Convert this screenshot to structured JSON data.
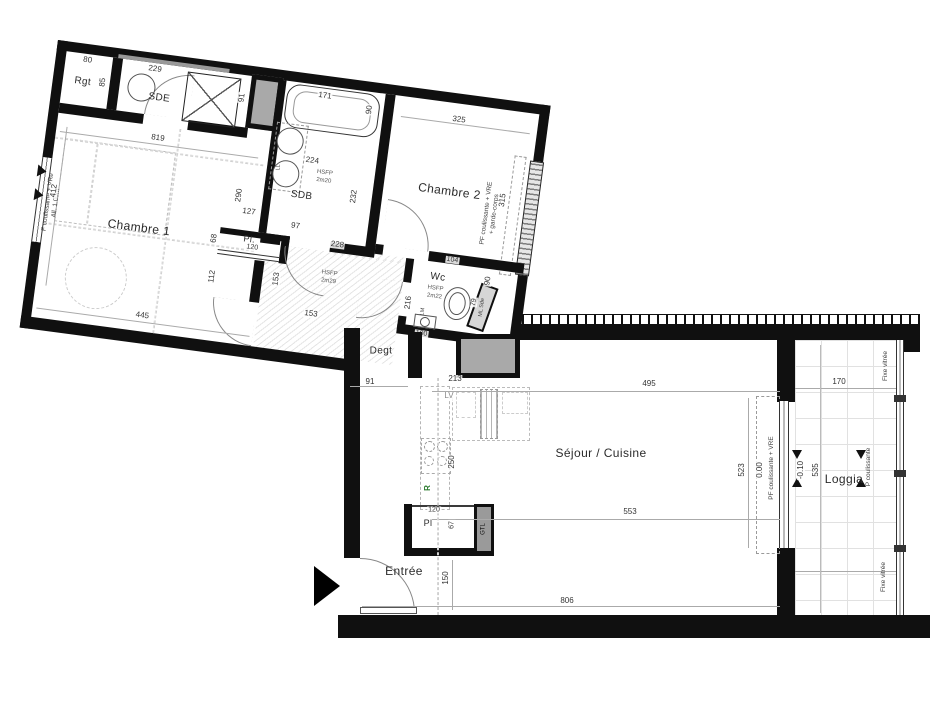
{
  "meta": {
    "wall_color": "#101010",
    "duct_color": "#a9a9a9",
    "accent_green": "#2e7d32"
  },
  "rooms": {
    "rgt": "Rgt",
    "sde": "SDE",
    "sdb": "SDB",
    "chambre1": "Chambre 1",
    "chambre2": "Chambre 2",
    "wc": "Wc",
    "degt": "Degt",
    "sejour": "Séjour / Cuisine",
    "entree": "Entrée",
    "loggia": "Loggia",
    "pl1": "Pl.",
    "pl2": "Pl"
  },
  "fixtures": {
    "lv": "LV",
    "fridge": "R",
    "gtl": "GTL",
    "ll": "LL",
    "lm": "LM",
    "ml_sde": "ML Sde"
  },
  "heights": {
    "sdb_l1": "HSFP",
    "sdb_l2": "2m20",
    "hall_l1": "HSFP",
    "hall_l2": "2m29",
    "wc_l1": "HSFP",
    "wc_l2": "2m22"
  },
  "windows": {
    "left_l1": "F coulissante + VRe",
    "left_l2": "All. 1.00m",
    "ch2_l1": "PF coulissante + VRE",
    "ch2_l2": "+ garde-corps",
    "sejour": "PF coulissante + VRE",
    "fixed_top": "Fixe vitrée",
    "fixed_bottom": "Fixe vitrée",
    "p_coulissante": "P coulissante"
  },
  "levels": {
    "sejour": "0.00",
    "loggia": "-0.10"
  },
  "dims": {
    "rgt_w": "80",
    "rgt_h": "85",
    "sde_w": "229",
    "shower_h": "91",
    "sde_below": "819",
    "bath_w": "171",
    "bath_h": "90",
    "sdb_w": "224",
    "sdb_h": "232",
    "sdb_bottom": "127",
    "sdb_below": "97",
    "ch1_left": "412",
    "ch1_right": "290",
    "ch1_bottom": "445",
    "ch2_w": "325",
    "ch2_h": "315",
    "ch2_bottom": "228",
    "pl1_w": "120",
    "pl1_h": "68",
    "hall_v": "112",
    "hall_w": "153",
    "hall_h": "153",
    "wc_top": "104",
    "wc_side": "90",
    "wc_seat": "79",
    "wc_bottom": "100",
    "wc_left": "216",
    "degt_w": "91",
    "kitchen_w": "213",
    "kitchen_h": "250",
    "sejour_top": "495",
    "sejour_mid": "553",
    "sejour_right": "523",
    "bottom_w": "806",
    "entree_h": "150",
    "pl2_w": "120",
    "pl2_h": "67",
    "loggia_w": "170",
    "loggia_h": "535"
  }
}
